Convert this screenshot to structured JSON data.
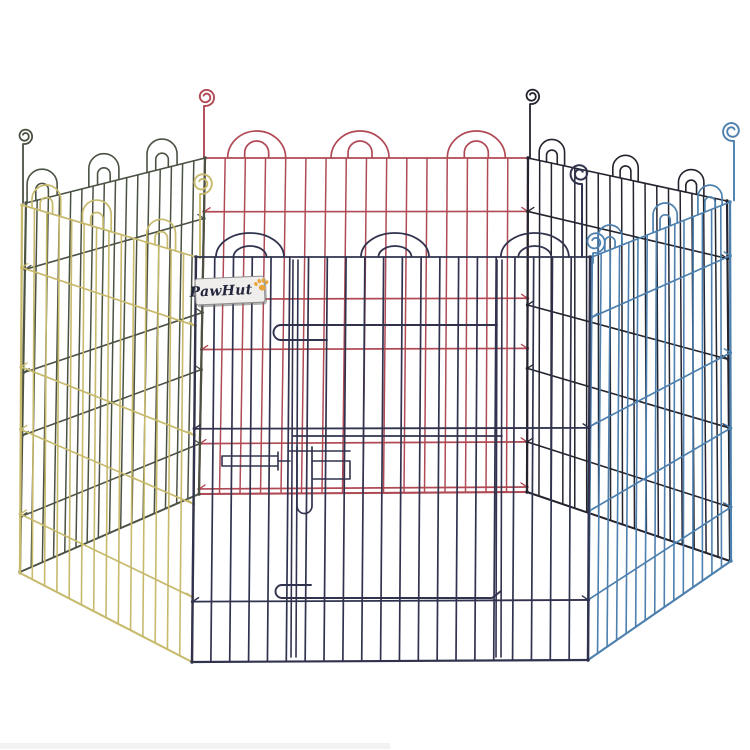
{
  "image": {
    "type": "product-photo",
    "subject": "PawHut six-panel hexagonal metal pet playpen with door",
    "background": "#ffffff",
    "width": 750,
    "height": 750
  },
  "brand_label": {
    "text": "PawHut",
    "x": 195,
    "y": 277,
    "width": 70,
    "height": 27,
    "rotation_deg": -2.5,
    "bg": "#efeeec",
    "border_color": "#8f8f8f",
    "shadow_color": "rgba(110,110,110,0.55)",
    "text_color": "#23263c",
    "paw_color": "#e9a43c"
  },
  "footer_smudge": {
    "x": 0,
    "y": 743,
    "width": 390,
    "height": 6,
    "color": "#f2f2f2"
  },
  "scene": {
    "panels": [
      {
        "name": "back-center-panel-red",
        "color": "#b04a55",
        "wire_w": 1.5,
        "edge_w": 2.2,
        "rail_w": 1.7,
        "top": [
          [
            205,
            158
          ],
          [
            528,
            158
          ]
        ],
        "bottom": [
          [
            199,
            494
          ],
          [
            527,
            492
          ]
        ],
        "wires": 15,
        "rails": [
          0.16,
          0.42,
          0.57,
          0.85,
          0.985
        ],
        "arches": {
          "centers": [
            0.16,
            0.48,
            0.84
          ],
          "outer_w": 58,
          "outer_h": 27,
          "inner_w": 24,
          "inner_h": 17
        },
        "stake": {
          "x": 204,
          "top": 88,
          "r": 9,
          "dir": -1
        }
      },
      {
        "name": "back-left-panel-green",
        "color": "#4a5243",
        "wire_w": 1.5,
        "edge_w": 2.2,
        "rail_w": 1.6,
        "top": [
          [
            26,
            203
          ],
          [
            205,
            158
          ]
        ],
        "bottom": [
          [
            20,
            572
          ],
          [
            199,
            494
          ]
        ],
        "wires": 15,
        "rails": [
          0.18,
          0.46,
          0.63,
          0.85
        ],
        "arches": {
          "centers": [
            0.09,
            0.435,
            0.76
          ],
          "outer_w": 31,
          "outer_h": 26,
          "inner_w": 13,
          "inner_h": 14
        },
        "stake": {
          "x": 23,
          "top": 128,
          "r": 8,
          "dir": -1
        }
      },
      {
        "name": "back-right-panel-black",
        "color": "#23242e",
        "wire_w": 1.5,
        "edge_w": 2.2,
        "rail_w": 1.6,
        "top": [
          [
            528,
            158
          ],
          [
            727,
            201
          ]
        ],
        "bottom": [
          [
            527,
            492
          ],
          [
            730,
            561
          ]
        ],
        "wires": 16,
        "rails": [
          0.16,
          0.44,
          0.63,
          0.85
        ],
        "arches": {
          "centers": [
            0.12,
            0.49,
            0.82
          ],
          "outer_w": 26,
          "outer_h": 21,
          "inner_w": 11,
          "inner_h": 12
        },
        "stake": {
          "x": 530,
          "top": 88,
          "r": 8,
          "dir": -1
        }
      },
      {
        "name": "front-left-panel-yellow",
        "color": "#c7ba6d",
        "wire_w": 1.6,
        "edge_w": 2.3,
        "rail_w": 1.7,
        "top": [
          [
            22,
            205
          ],
          [
            196,
            257
          ]
        ],
        "bottom": [
          [
            20,
            573
          ],
          [
            192,
            662
          ]
        ],
        "wires": 13,
        "rails": [
          0.17,
          0.44,
          0.61,
          0.84
        ],
        "arches": {
          "centers": [
            0.14,
            0.43,
            0.8
          ],
          "outer_w": 30,
          "outer_h": 23,
          "inner_w": 13,
          "inner_h": 13
        },
        "stake": {
          "x": 200,
          "top": 172,
          "r": 11,
          "dir": -1
        }
      },
      {
        "name": "front-right-panel-blue",
        "color": "#4d80ae",
        "wire_w": 1.6,
        "edge_w": 2.3,
        "rail_w": 1.7,
        "top": [
          [
            592,
            257
          ],
          [
            730,
            202
          ]
        ],
        "bottom": [
          [
            588,
            660
          ],
          [
            731,
            561
          ]
        ],
        "wires": 14,
        "rails": [
          0.15,
          0.42,
          0.63,
          0.85
        ],
        "arches": {
          "centers": [
            0.13,
            0.53,
            0.855
          ],
          "outer_w": 26,
          "outer_h": 20,
          "inner_w": 11,
          "inner_h": 11
        },
        "stake": {
          "x": 734,
          "top": 121,
          "r": 10,
          "dir": 1
        }
      },
      {
        "name": "front-center-panel-navy",
        "color": "#31334e",
        "wire_w": 1.7,
        "edge_w": 2.4,
        "rail_w": 1.8,
        "top": [
          [
            196,
            257
          ],
          [
            590,
            257
          ]
        ],
        "bottom": [
          [
            192,
            662
          ],
          [
            588,
            660
          ]
        ],
        "wires": 20,
        "rails": [
          0.424,
          0.851
        ],
        "arches": {
          "centers": [
            0.137,
            0.505,
            0.86
          ],
          "outer_w": 68,
          "outer_h": 24,
          "inner_w": 33,
          "inner_h": 11
        },
        "stake": {
          "x": 582,
          "top": 163,
          "r": 10.5,
          "dir": 1
        }
      }
    ],
    "extra_stakes": [
      {
        "name": "front-right-junction-curl-blue",
        "color": "#4d80ae",
        "x": 593,
        "base_y": 263,
        "top": 231,
        "r": 11,
        "dir": -1
      }
    ],
    "front_hardware": {
      "color": "#31334e",
      "paths": [
        {
          "name": "door-left-edge-wires",
          "d": "M293,260 L291,657 M298,260 L296,657",
          "w": 1.6
        },
        {
          "name": "door-right-edge-wires",
          "d": "M497,260 L496,657 M502,260 L501,657",
          "w": 1.6
        },
        {
          "name": "door-top-rail-and-latch-handle",
          "d": "M497,325 L281,325 A7.5,7.5 0 0 0 281,340 L327,340",
          "w": 1.9
        },
        {
          "name": "door-mid-rail",
          "d": "M293,436 L502,436",
          "w": 1.7
        },
        {
          "name": "door-bottom-rail-and-latch-handle",
          "d": "M311,585 L282,585 A6.5,6.5 0 0 0 282,598 L492,598 L501,591",
          "w": 1.9
        },
        {
          "name": "latch-slider-plate",
          "d": "M222,456 L278,456 M222,466 L278,466 M222,456 L222,466 M278,452 L278,470",
          "w": 1.6
        },
        {
          "name": "latch-link-wire",
          "d": "M278,461 L290,461",
          "w": 1.6
        },
        {
          "name": "latch-bolt-hairpin",
          "d": "M297,447 L297,506 A7.5,7.5 0 0 0 312,506 L312,447",
          "w": 1.7
        },
        {
          "name": "latch-bracket",
          "d": "M312,461 L350,461 L350,479 L313,479 M288,451 L350,451",
          "w": 1.6
        }
      ]
    }
  }
}
